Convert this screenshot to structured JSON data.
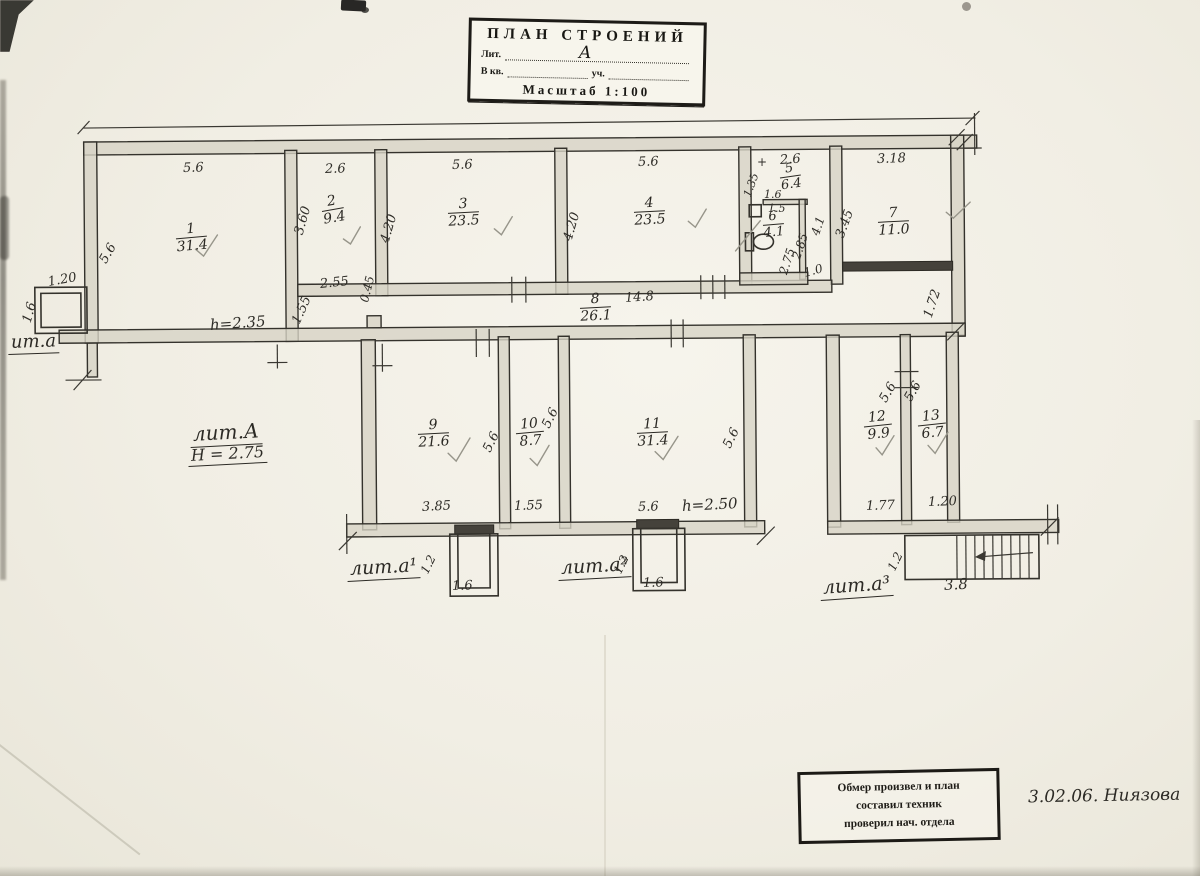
{
  "title_block": {
    "title": "ПЛАН СТРОЕНИЙ",
    "lit_label": "Лит.",
    "lit_value": "А",
    "kv_label": "В кв.",
    "uch_label": "уч.",
    "scale": "Масштаб 1:100"
  },
  "plan": {
    "rooms": [
      {
        "num": "1",
        "area": "31.4"
      },
      {
        "num": "2",
        "area": "9.4"
      },
      {
        "num": "3",
        "area": "23.5"
      },
      {
        "num": "4",
        "area": "23.5"
      },
      {
        "num": "5",
        "area": "6.4"
      },
      {
        "num": "6",
        "area": "4.1"
      },
      {
        "num": "7",
        "area": "11.0"
      },
      {
        "num": "8",
        "area": "26.1"
      },
      {
        "num": "9",
        "area": "21.6"
      },
      {
        "num": "10",
        "area": "8.7"
      },
      {
        "num": "11",
        "area": "31.4"
      },
      {
        "num": "12",
        "area": "9.9"
      },
      {
        "num": "13",
        "area": "6.7"
      }
    ],
    "dims": {
      "r1_top": "5.6",
      "r1_left": "5.6",
      "r1_height": "h=2.35",
      "r2_top": "2.6",
      "r2_left": "3.60",
      "r2_bot": "2.55",
      "r2_gap": "0.45",
      "r2_pass": "1.55",
      "r3_top": "5.6",
      "r3_left": "4.20",
      "r4_top": "5.6",
      "r4_left": "4.20",
      "r5_plus": "+",
      "r5_top": "2.6",
      "r5_left": "1.35",
      "r5_step": "1.6",
      "r5_col": "4.1",
      "r6_top": "1.5",
      "r6_left": "2.75",
      "r6_mid": "2.85",
      "r6_bot": "1.0",
      "r7_top": "3.18",
      "r7_left": "3.45",
      "r7_below": "1.72",
      "corridor": "14.8",
      "r9_bot": "3.85",
      "r9_right": "5.6",
      "r10_bot": "1.55",
      "r10_right": "5.6",
      "r11_bot": "5.6",
      "r11_height": "h=2.50",
      "r11_right": "5.6",
      "r12_bot": "1.77",
      "r12_left": "5.6",
      "r13_bot": "1.20",
      "r13_left": "5.6",
      "porch_left_w": "1.20",
      "porch_left_d": "1.6",
      "porch1_w": "1.6",
      "porch1_d": "1.2",
      "porch2_w": "1.6",
      "porch2_d": "1.2",
      "stairs_w": "3.8",
      "stairs_d": "1.2"
    },
    "wings": {
      "left_porch": "ит.а",
      "main_lit": "лит.А",
      "main_height": "Н = 2.75",
      "a1": "лит.а¹",
      "a2": "лит.а²",
      "a3": "лит.а³"
    }
  },
  "stamp": {
    "line1": "Обмер произвел и план",
    "line2": "составил техник",
    "line3": "проверил нач. отдела"
  },
  "handwritten_note": "3.02.06. Ниязова"
}
